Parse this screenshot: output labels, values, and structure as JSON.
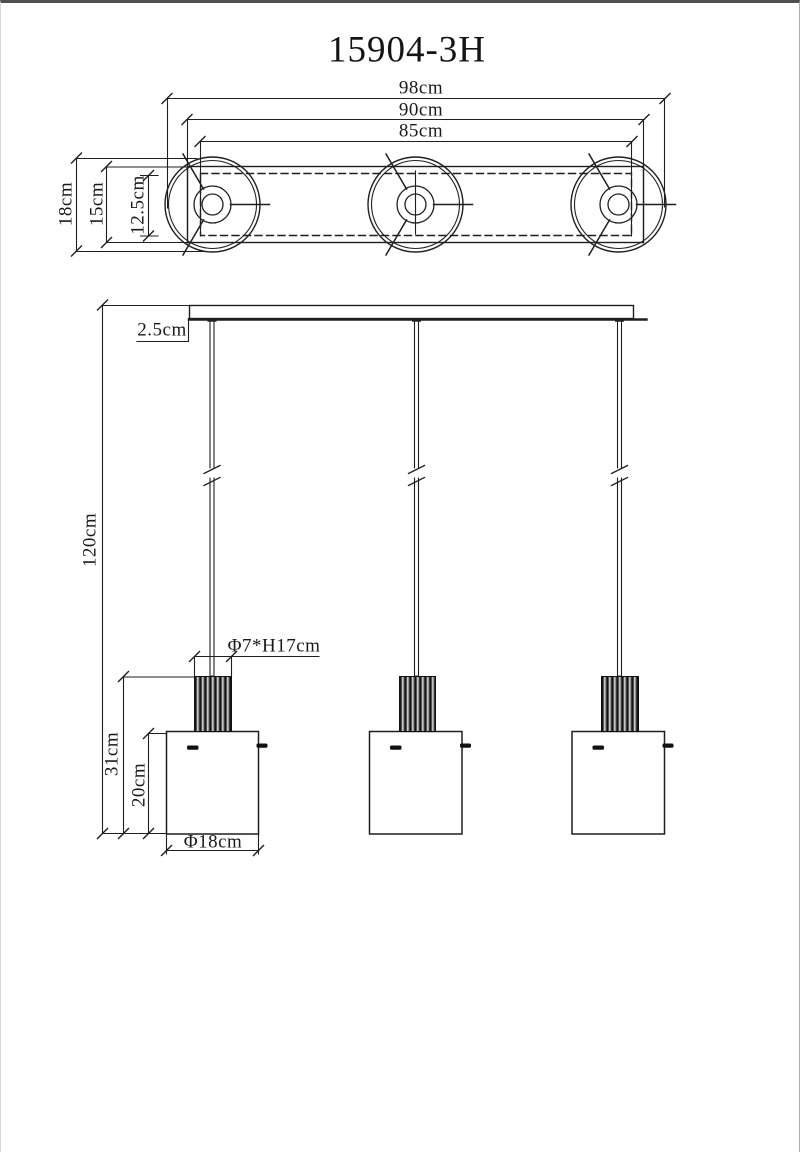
{
  "title": "15904-3H",
  "top_view": {
    "width_overall_label": "98cm",
    "width_bar_label": "90cm",
    "width_centers_label": "85cm",
    "shade_diameter_label": "18cm",
    "bar_depth_label": "15cm",
    "inner_depth_label": "12.5cm"
  },
  "front_view": {
    "total_drop_label": "120cm",
    "canopy_height_label": "2.5cm",
    "cylinder_size_label": "Φ7*H17cm",
    "fixture_height_label": "31cm",
    "shade_height_label": "20cm",
    "shade_diameter_label": "Φ18cm"
  },
  "colors": {
    "line": "#1f1f1f",
    "background": "#ffffff"
  }
}
